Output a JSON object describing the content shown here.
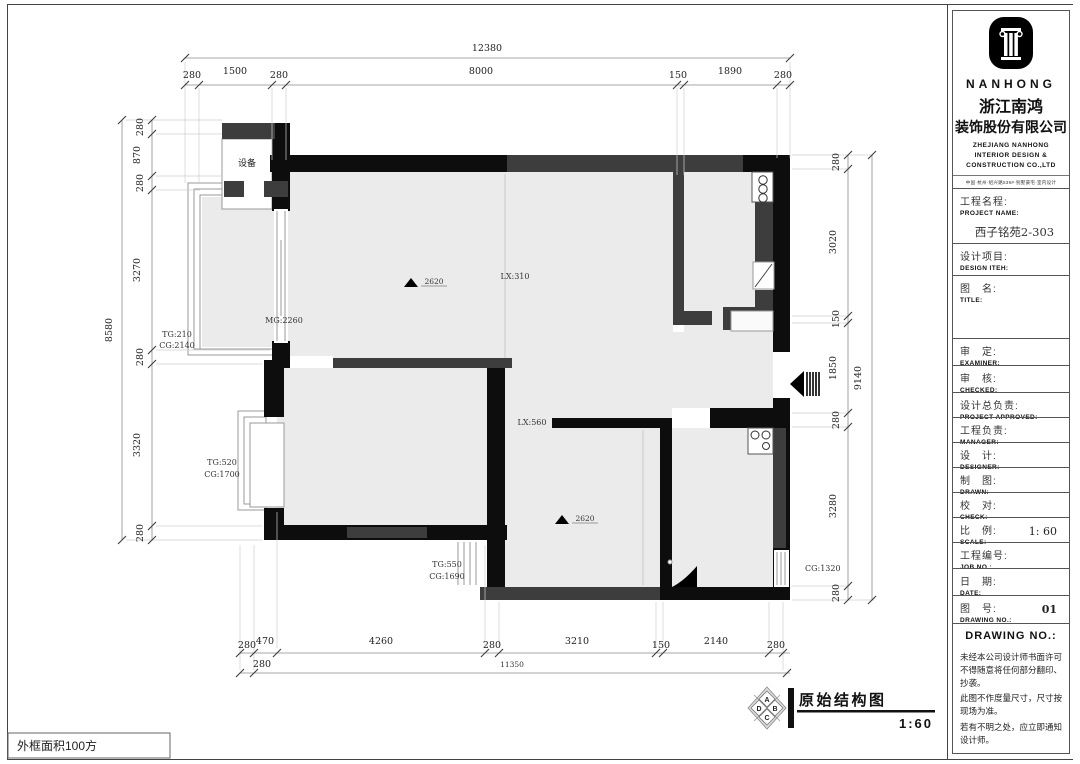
{
  "colors": {
    "room_fill": "#ebebeb",
    "wall_black": "#0d0d0d",
    "wall_gray": "#3d3d3d",
    "dim_line": "#8a8a8a"
  },
  "dims": {
    "top_total": "12380",
    "top": [
      "280",
      "1500",
      "280",
      "8000",
      "150",
      "1890",
      "280"
    ],
    "left_total": "8580",
    "left": [
      "280",
      "870",
      "280",
      "3270",
      "280",
      "3320",
      "280"
    ],
    "right_total": "9140",
    "right": [
      "280",
      "3020",
      "150",
      "1850",
      "280",
      "3280",
      "280"
    ],
    "bottom": [
      "280",
      "470",
      "4260",
      "280",
      "3210",
      "150",
      "2140",
      "280"
    ],
    "bottom2": [
      "280",
      "11350"
    ]
  },
  "plan": {
    "equipment": "设备",
    "balcony_tg": "TG:210",
    "balcony_cg": "CG:2140",
    "mg": "MG:2260",
    "lx_living": "LX:310",
    "beam_living": "2620",
    "lx_hall": "LX:560",
    "bed1_tg": "TG:520",
    "bed1_cg": "CG:1700",
    "bed1b_tg": "TG:550",
    "bed1b_cg": "CG:1690",
    "beam_bed2": "2620",
    "right_cg": "CG:1320"
  },
  "footer": {
    "area_note": "外框面积100方",
    "title": "原始结构图",
    "scale": "1:60",
    "compass": [
      "A",
      "B",
      "C",
      "D"
    ]
  },
  "company": {
    "brand": "NANHONG",
    "cn_line1": "浙江南鸿",
    "cn_line2": "装饰股份有限公司",
    "en_line1": "ZHEJIANG NANHONG",
    "en_line2": "INTERIOR DESIGN &",
    "en_line3": "CONSTRUCTION CO.,LTD",
    "address": "中国·杭州·绍兴路539#·别墅豪宅·室内设计",
    "tel": "TEL: (86)571-85812241 85812242"
  },
  "titleblock": {
    "rows": [
      {
        "zh": "工程名程:",
        "en": "PROJECT NAME:",
        "value": "西子铭苑2-303"
      },
      {
        "zh": "设计项目:",
        "en": "DESIGN ITEH:",
        "value": ""
      },
      {
        "zh": "图　名:",
        "en": "TITLE:",
        "value": ""
      },
      {
        "zh": "审　定:",
        "en": "EXAMINER:",
        "value": ""
      },
      {
        "zh": "审　核:",
        "en": "CHECKED:",
        "value": ""
      },
      {
        "zh": "设计总负责:",
        "en": "PROJECT APPROVED:",
        "value": ""
      },
      {
        "zh": "工程负责:",
        "en": "MANAGER:",
        "value": ""
      },
      {
        "zh": "设　计:",
        "en": "DESIGNER:",
        "value": ""
      },
      {
        "zh": "制　图:",
        "en": "DRAWN:",
        "value": ""
      },
      {
        "zh": "校　对:",
        "en": "CHECK:",
        "value": ""
      },
      {
        "zh": "比　例:",
        "en": "SCALE:",
        "value": "1: 60"
      },
      {
        "zh": "工程编号:",
        "en": "JOB NO.:",
        "value": ""
      },
      {
        "zh": "日　期:",
        "en": "DATE:",
        "value": ""
      },
      {
        "zh": "图　号:",
        "en": "DRAWING NO.:",
        "value": "01"
      }
    ],
    "notice_header": "DRAWING NO.:",
    "notes": [
      "未经本公司设计师书面许可不得随意将任何部分翻印、抄袭。",
      "此图不作度量尺寸，尺寸按现场为准。",
      "若有不明之处，应立即通知设计师。"
    ]
  }
}
